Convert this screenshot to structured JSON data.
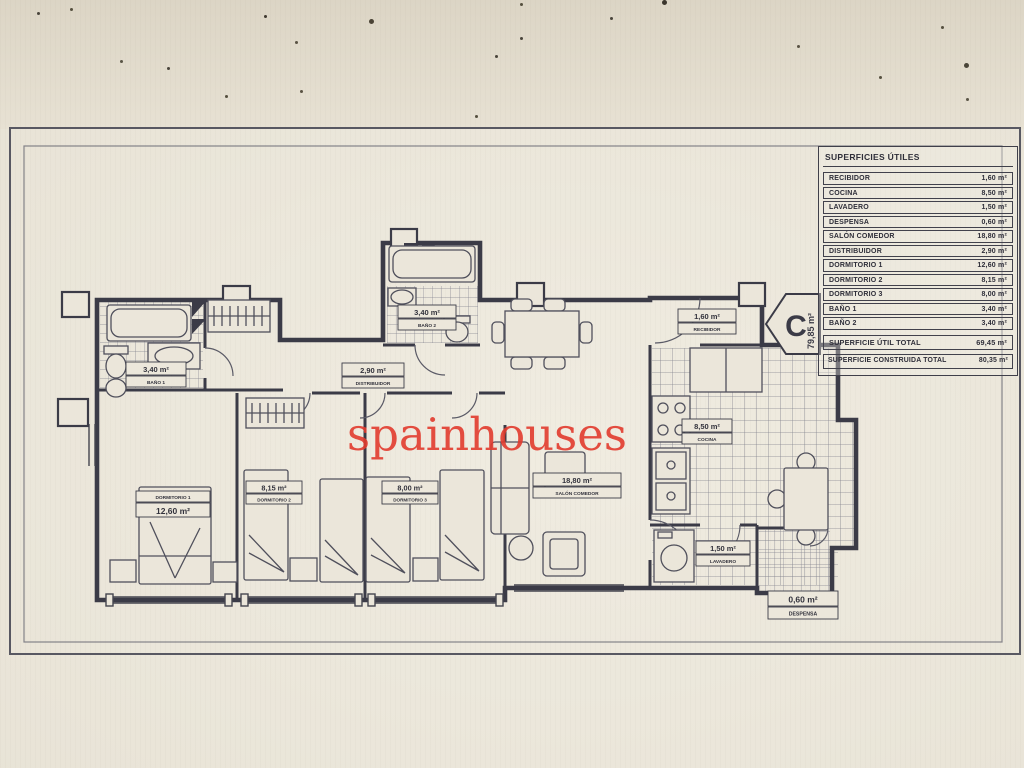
{
  "colors": {
    "ink": "#3b3b47",
    "watermark_red": "#e23b2e",
    "paper": "#ebe6da"
  },
  "watermark": "spainhouses",
  "unit_badge": {
    "letter": "C",
    "area": "79,85 m²"
  },
  "surface_table": {
    "title": "SUPERFICIES ÚTILES",
    "rows": [
      {
        "label": "RECIBIDOR",
        "value": "1,60 m²"
      },
      {
        "label": "COCINA",
        "value": "8,50 m²"
      },
      {
        "label": "LAVADERO",
        "value": "1,50 m²"
      },
      {
        "label": "DESPENSA",
        "value": "0,60 m²"
      },
      {
        "label": "SALÓN COMEDOR",
        "value": "18,80 m²"
      },
      {
        "label": "DISTRIBUIDOR",
        "value": "2,90 m²"
      },
      {
        "label": "DORMITORIO 1",
        "value": "12,60 m²"
      },
      {
        "label": "DORMITORIO 2",
        "value": "8,15 m²"
      },
      {
        "label": "DORMITORIO 3",
        "value": "8,00 m²"
      },
      {
        "label": "BAÑO 1",
        "value": "3,40 m²"
      },
      {
        "label": "BAÑO 2",
        "value": "3,40 m²"
      }
    ],
    "total": {
      "label": "SUPERFICIE ÚTIL TOTAL",
      "value": "69,45 m²"
    },
    "built_total": {
      "label": "SUPERFICIE CONSTRUIDA TOTAL",
      "value": "80,35 m²"
    }
  },
  "plan_labels": {
    "bano1": {
      "name": "BAÑO 1",
      "area": "3,40 m²"
    },
    "bano2": {
      "name": "BAÑO 2",
      "area": "3,40 m²"
    },
    "distribuidor": {
      "name": "DISTRIBUIDOR",
      "area": "2,90 m²"
    },
    "dormitorio1": {
      "name": "DORMITORIO 1",
      "area": "12,60 m²"
    },
    "dormitorio2": {
      "name": "DORMITORIO 2",
      "area": "8,15 m²"
    },
    "dormitorio3": {
      "name": "DORMITORIO 3",
      "area": "8,00 m²"
    },
    "salon": {
      "name": "SALÓN COMEDOR",
      "area": "18,80 m²"
    },
    "recibidor": {
      "name": "RECIBIDOR",
      "area": "1,60 m²"
    },
    "cocina": {
      "name": "COCINA",
      "area": "8,50 m²"
    },
    "lavadero": {
      "name": "LAVADERO",
      "area": "1,50 m²"
    },
    "despensa": {
      "name": "DESPENSA",
      "area": "0,60 m²"
    }
  }
}
